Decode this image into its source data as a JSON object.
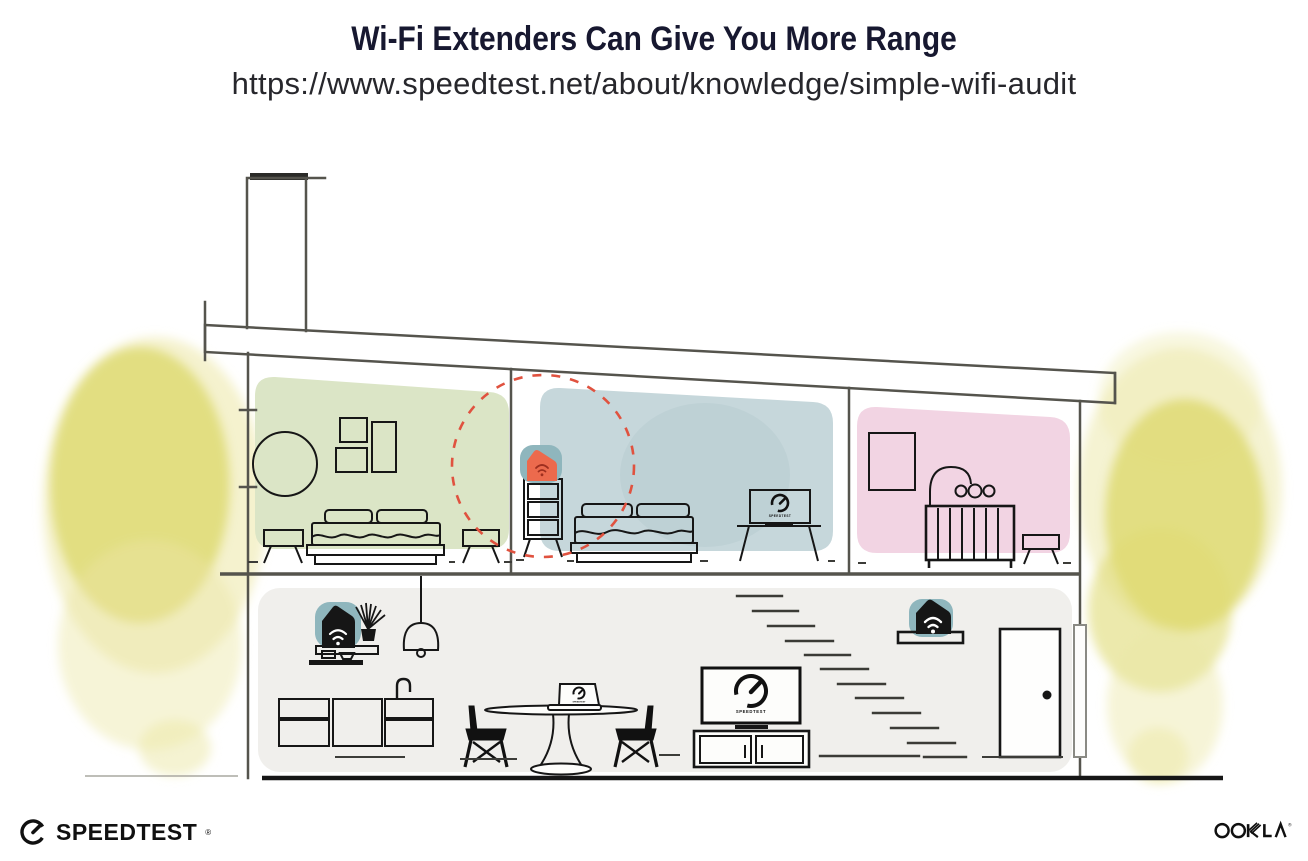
{
  "page": {
    "title": "Wi-Fi Extenders Can Give You More Range",
    "subtitle_url": "https://www.speedtest.net/about/knowledge/simple-wifi-audit"
  },
  "branding": {
    "speedtest_wordmark": "SPEEDTEST",
    "speedtest_trademark": "®",
    "ookla_wordmark": "OOKLA",
    "ookla_trademark": "®"
  },
  "screens": {
    "bedroom_tv_label": "SPEEDTEST",
    "living_tv_label": "SPEEDTEST",
    "laptop_label": "SPEEDTEST"
  },
  "palette": {
    "ink": "#171830",
    "url-ink": "#27272c",
    "line": "#55544d",
    "furniture": "#161616",
    "room-green": "#dbe5c6",
    "room-blue": "#c6d7db",
    "room-pink": "#f2d4e3",
    "floor-gray": "#f0efec",
    "device-teal": "#8fb6bd",
    "extender-orange": "#ec6a4d",
    "extender-icon": "#9e2f1f",
    "coverage-red": "#e0523f",
    "tree-main": "#dfda74",
    "tree-light": "#ece7a6"
  }
}
